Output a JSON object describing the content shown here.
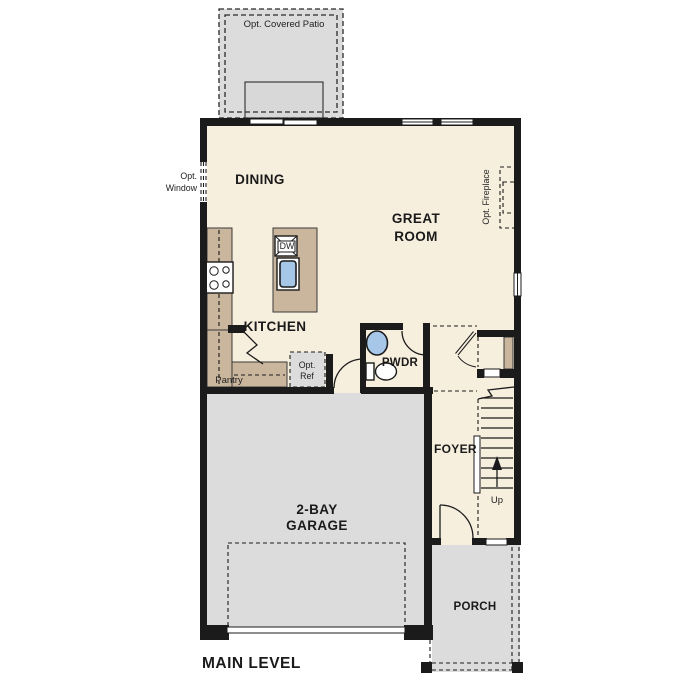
{
  "title": {
    "label": "MAIN LEVEL"
  },
  "rooms": {
    "dining": "DINING",
    "great_room_line1": "GREAT",
    "great_room_line2": "ROOM",
    "kitchen": "KITCHEN",
    "pwdr": "PWDR",
    "foyer": "FOYER",
    "garage_line1": "2-BAY",
    "garage_line2": "GARAGE",
    "porch": "PORCH"
  },
  "features": {
    "opt_covered_patio": "Opt. Covered Patio",
    "opt_window_line1": "Opt.",
    "opt_window_line2": "Window",
    "opt_fireplace": "Opt. Fireplace",
    "pantry": "Pantry",
    "opt_ref_line1": "Opt.",
    "opt_ref_line2": "Ref",
    "dishwasher": "DW",
    "stairs_up": "Up"
  },
  "colors": {
    "wall": "#1b1b1b",
    "floor": "#f7efde",
    "counter": "#c9b69c",
    "concrete": "#dcdcdd",
    "fixture_blue": "#a7c7e8"
  }
}
